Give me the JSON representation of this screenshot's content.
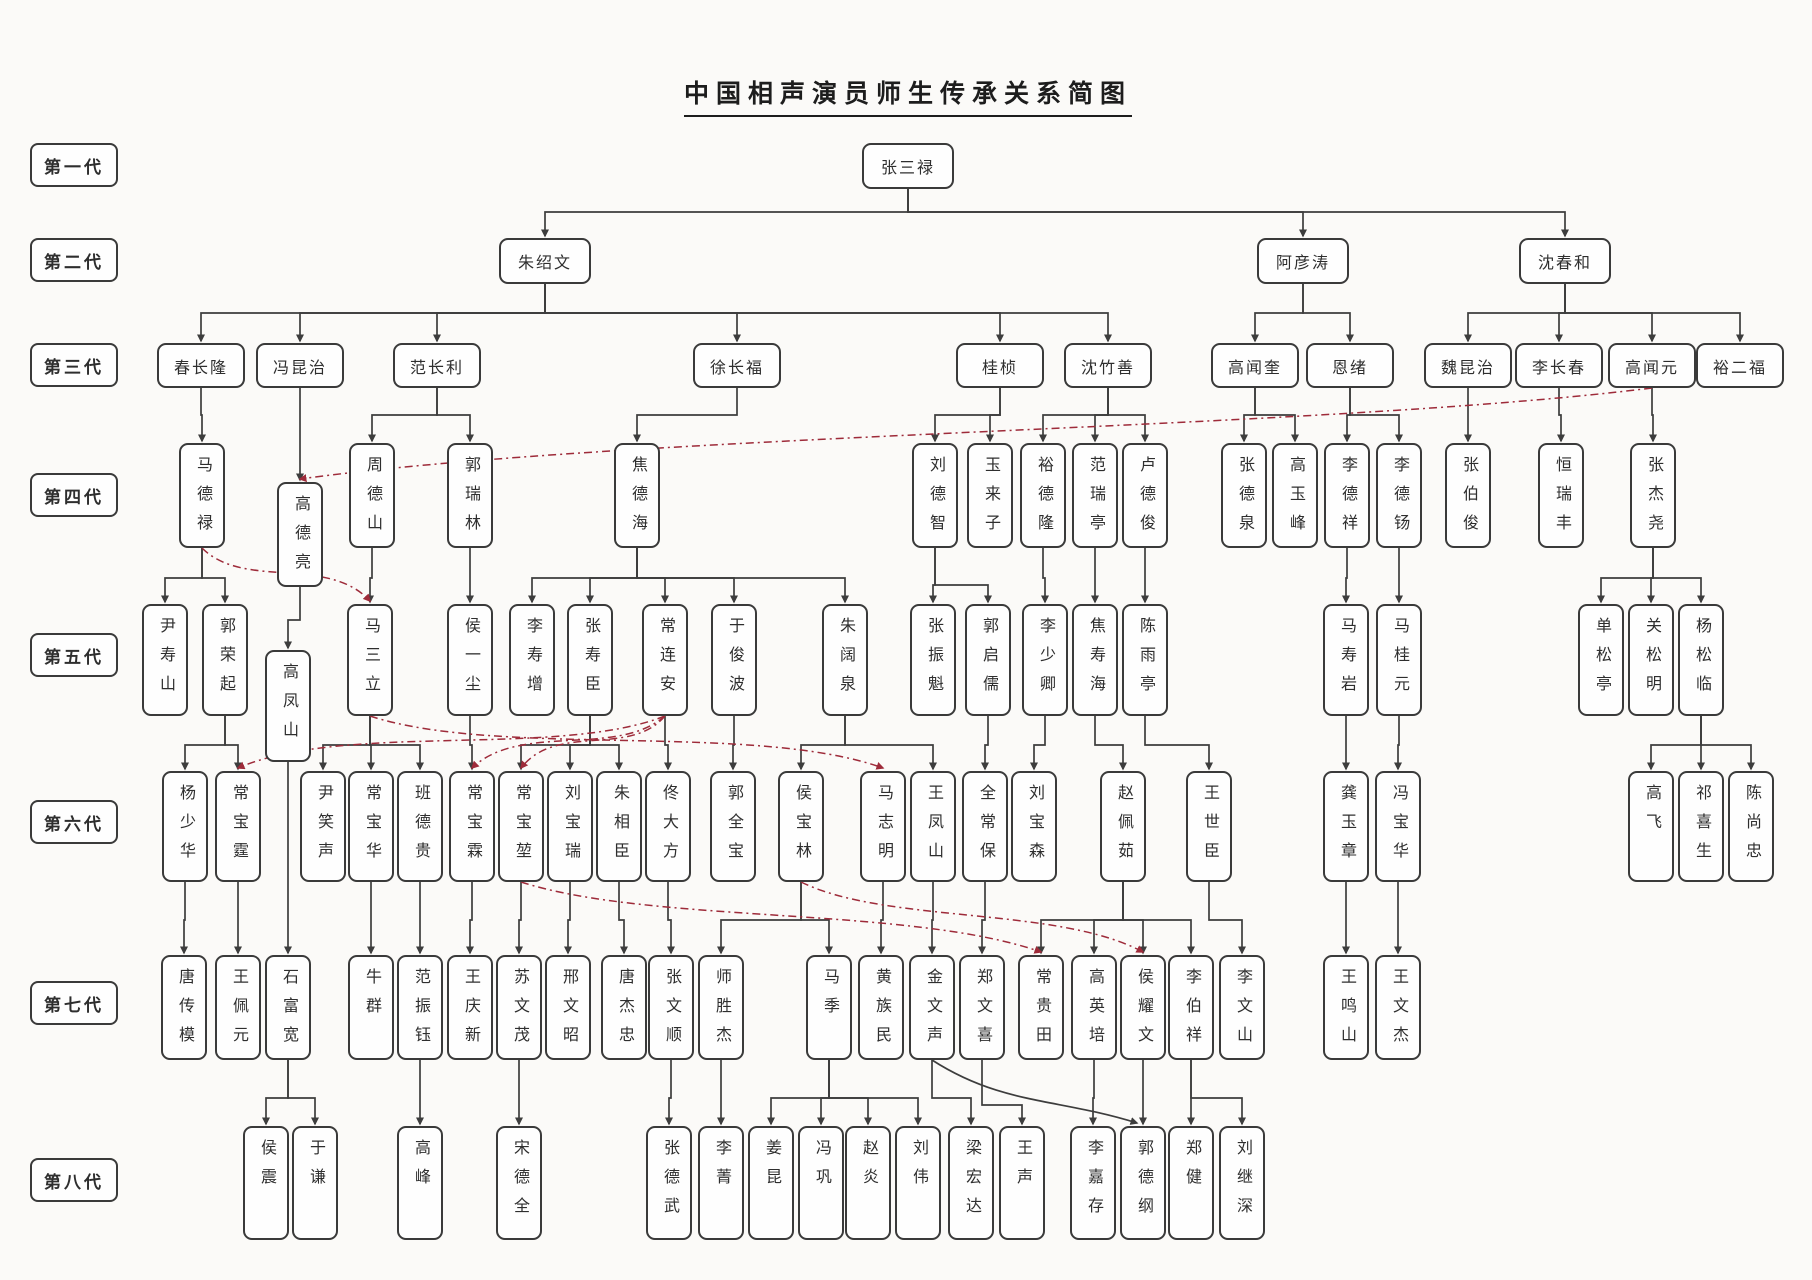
{
  "title": "中国相声演员师生传承关系简图",
  "colors": {
    "background": "#fbfaf8",
    "box_border": "#3a3a3a",
    "teacher_line": "#3d3d3d",
    "family_line": "#9e2b3a",
    "text": "#2e2e2e"
  },
  "generation_defaults": {
    "1": {
      "y": 143,
      "w": 92,
      "h": 46,
      "orient": "h"
    },
    "2": {
      "y": 238,
      "w": 92,
      "h": 46,
      "orient": "h"
    },
    "3": {
      "y": 343,
      "w": 88,
      "h": 45,
      "orient": "h"
    },
    "4": {
      "y": 443,
      "w": 46,
      "h": 105,
      "orient": "v"
    },
    "5": {
      "y": 604,
      "w": 46,
      "h": 112,
      "orient": "v"
    },
    "6": {
      "y": 771,
      "w": 46,
      "h": 111,
      "orient": "v"
    },
    "7": {
      "y": 955,
      "w": 46,
      "h": 105,
      "orient": "v"
    },
    "8": {
      "y": 1126,
      "w": 46,
      "h": 114,
      "orient": "v"
    }
  },
  "generations": [
    {
      "label": "第一代",
      "label_y": 143,
      "people": [
        {
          "name": "张三禄",
          "x": 908
        }
      ]
    },
    {
      "label": "第二代",
      "label_y": 238,
      "people": [
        {
          "name": "朱绍文",
          "x": 545
        },
        {
          "name": "阿彦涛",
          "x": 1303
        },
        {
          "name": "沈春和",
          "x": 1565
        }
      ]
    },
    {
      "label": "第三代",
      "label_y": 343,
      "people": [
        {
          "name": "春长隆",
          "x": 201
        },
        {
          "name": "冯昆治",
          "x": 300
        },
        {
          "name": "范长利",
          "x": 437
        },
        {
          "name": "徐长福",
          "x": 737
        },
        {
          "name": "桂桢",
          "x": 1000
        },
        {
          "name": "沈竹善",
          "x": 1108
        },
        {
          "name": "高闻奎",
          "x": 1255
        },
        {
          "name": "恩绪",
          "x": 1350
        },
        {
          "name": "魏昆治",
          "x": 1468
        },
        {
          "name": "李长春",
          "x": 1559
        },
        {
          "name": "高闻元",
          "x": 1652
        },
        {
          "name": "裕二福",
          "x": 1740
        }
      ]
    },
    {
      "label": "第四代",
      "label_y": 473,
      "people": [
        {
          "name": "马德禄",
          "x": 202
        },
        {
          "name": "高德亮",
          "x": 300,
          "y": 482
        },
        {
          "name": "周德山",
          "x": 372
        },
        {
          "name": "郭瑞林",
          "x": 470
        },
        {
          "name": "焦德海",
          "x": 637
        },
        {
          "name": "刘德智",
          "x": 935
        },
        {
          "name": "玉来子",
          "x": 990
        },
        {
          "name": "裕德隆",
          "x": 1043
        },
        {
          "name": "范瑞亭",
          "x": 1095
        },
        {
          "name": "卢德俊",
          "x": 1145
        },
        {
          "name": "张德泉",
          "x": 1244
        },
        {
          "name": "高玉峰",
          "x": 1295
        },
        {
          "name": "李德祥",
          "x": 1347
        },
        {
          "name": "李德钖",
          "x": 1399
        },
        {
          "name": "张伯俊",
          "x": 1468
        },
        {
          "name": "恒瑞丰",
          "x": 1561
        },
        {
          "name": "张杰尧",
          "x": 1653
        }
      ]
    },
    {
      "label": "第五代",
      "label_y": 633,
      "people": [
        {
          "name": "尹寿山",
          "x": 165
        },
        {
          "name": "郭荣起",
          "x": 225
        },
        {
          "name": "高凤山",
          "x": 288,
          "y": 650
        },
        {
          "name": "马三立",
          "x": 370
        },
        {
          "name": "侯一尘",
          "x": 470
        },
        {
          "name": "李寿增",
          "x": 532
        },
        {
          "name": "张寿臣",
          "x": 590
        },
        {
          "name": "常连安",
          "x": 665
        },
        {
          "name": "于俊波",
          "x": 734
        },
        {
          "name": "朱阔泉",
          "x": 845
        },
        {
          "name": "张振魁",
          "x": 933
        },
        {
          "name": "郭启儒",
          "x": 988
        },
        {
          "name": "李少卿",
          "x": 1045
        },
        {
          "name": "焦寿海",
          "x": 1095
        },
        {
          "name": "陈雨亭",
          "x": 1145
        },
        {
          "name": "马寿岩",
          "x": 1346
        },
        {
          "name": "马桂元",
          "x": 1399
        },
        {
          "name": "单松亭",
          "x": 1601
        },
        {
          "name": "关松明",
          "x": 1651
        },
        {
          "name": "杨松临",
          "x": 1701
        }
      ]
    },
    {
      "label": "第六代",
      "label_y": 800,
      "people": [
        {
          "name": "杨少华",
          "x": 185
        },
        {
          "name": "常宝霆",
          "x": 238
        },
        {
          "name": "尹笑声",
          "x": 323
        },
        {
          "name": "常宝华",
          "x": 371
        },
        {
          "name": "班德贵",
          "x": 420
        },
        {
          "name": "常宝霖",
          "x": 472
        },
        {
          "name": "常宝堃",
          "x": 521
        },
        {
          "name": "刘宝瑞",
          "x": 570
        },
        {
          "name": "朱相臣",
          "x": 619
        },
        {
          "name": "佟大方",
          "x": 668
        },
        {
          "name": "郭全宝",
          "x": 733
        },
        {
          "name": "侯宝林",
          "x": 801
        },
        {
          "name": "马志明",
          "x": 883
        },
        {
          "name": "王凤山",
          "x": 933
        },
        {
          "name": "全常保",
          "x": 985
        },
        {
          "name": "刘宝森",
          "x": 1034
        },
        {
          "name": "赵佩茹",
          "x": 1123
        },
        {
          "name": "王世臣",
          "x": 1209
        },
        {
          "name": "龚玉章",
          "x": 1346
        },
        {
          "name": "冯宝华",
          "x": 1398
        },
        {
          "name": "高飞",
          "x": 1651
        },
        {
          "name": "祁喜生",
          "x": 1701
        },
        {
          "name": "陈尚忠",
          "x": 1751
        }
      ]
    },
    {
      "label": "第七代",
      "label_y": 981,
      "people": [
        {
          "name": "唐传模",
          "x": 184
        },
        {
          "name": "王佩元",
          "x": 238
        },
        {
          "name": "石富宽",
          "x": 288
        },
        {
          "name": "牛群",
          "x": 371
        },
        {
          "name": "范振钰",
          "x": 420
        },
        {
          "name": "王庆新",
          "x": 470
        },
        {
          "name": "苏文茂",
          "x": 519
        },
        {
          "name": "邢文昭",
          "x": 568
        },
        {
          "name": "唐杰忠",
          "x": 624
        },
        {
          "name": "张文顺",
          "x": 671
        },
        {
          "name": "师胜杰",
          "x": 721
        },
        {
          "name": "马季",
          "x": 829
        },
        {
          "name": "黄族民",
          "x": 881
        },
        {
          "name": "金文声",
          "x": 932
        },
        {
          "name": "郑文喜",
          "x": 982
        },
        {
          "name": "常贵田",
          "x": 1041
        },
        {
          "name": "高英培",
          "x": 1094
        },
        {
          "name": "侯耀文",
          "x": 1143
        },
        {
          "name": "李伯祥",
          "x": 1191
        },
        {
          "name": "李文山",
          "x": 1242
        },
        {
          "name": "王鸣山",
          "x": 1346
        },
        {
          "name": "王文杰",
          "x": 1398
        }
      ]
    },
    {
      "label": "第八代",
      "label_y": 1158,
      "people": [
        {
          "name": "侯震",
          "x": 266
        },
        {
          "name": "于谦",
          "x": 315
        },
        {
          "name": "高峰",
          "x": 420
        },
        {
          "name": "宋德全",
          "x": 519
        },
        {
          "name": "张德武",
          "x": 669
        },
        {
          "name": "李菁",
          "x": 721
        },
        {
          "name": "姜昆",
          "x": 771
        },
        {
          "name": "冯巩",
          "x": 821
        },
        {
          "name": "赵炎",
          "x": 868
        },
        {
          "name": "刘伟",
          "x": 918
        },
        {
          "name": "梁宏达",
          "x": 971
        },
        {
          "name": "王声",
          "x": 1022
        },
        {
          "name": "李嘉存",
          "x": 1093
        },
        {
          "name": "郭德纲",
          "x": 1143
        },
        {
          "name": "郑健",
          "x": 1191
        },
        {
          "name": "刘继深",
          "x": 1242
        }
      ]
    }
  ],
  "teacher_edges": [
    {
      "from": "张三禄",
      "to": [
        "朱绍文",
        "阿彦涛",
        "沈春和"
      ],
      "bus": 212
    },
    {
      "from": "朱绍文",
      "to": [
        "春长隆",
        "冯昆治",
        "范长利",
        "徐长福",
        "桂桢",
        "沈竹善"
      ],
      "bus": 313
    },
    {
      "from": "阿彦涛",
      "to": [
        "高闻奎",
        "恩绪"
      ],
      "bus": 313
    },
    {
      "from": "沈春和",
      "to": [
        "魏昆治",
        "李长春",
        "高闻元",
        "裕二福"
      ],
      "bus": 313
    },
    {
      "from": "春长隆",
      "to": [
        "马德禄"
      ],
      "bus": 415
    },
    {
      "from": "冯昆治",
      "to": [
        "高德亮"
      ],
      "bus": 415
    },
    {
      "from": "范长利",
      "to": [
        "周德山",
        "郭瑞林"
      ],
      "bus": 415
    },
    {
      "from": "徐长福",
      "to": [
        "焦德海"
      ],
      "bus": 415
    },
    {
      "from": "桂桢",
      "to": [
        "刘德智",
        "玉来子"
      ],
      "bus": 415
    },
    {
      "from": "沈竹善",
      "to": [
        "裕德隆",
        "范瑞亭",
        "卢德俊"
      ],
      "bus": 415
    },
    {
      "from": "高闻奎",
      "to": [
        "张德泉",
        "高玉峰"
      ],
      "bus": 415
    },
    {
      "from": "恩绪",
      "to": [
        "李德祥",
        "李德钖"
      ],
      "bus": 415
    },
    {
      "from": "魏昆治",
      "to": [
        "张伯俊"
      ],
      "bus": 415
    },
    {
      "from": "李长春",
      "to": [
        "恒瑞丰"
      ],
      "bus": 415
    },
    {
      "from": "高闻元",
      "to": [
        "张杰尧"
      ],
      "bus": 415
    },
    {
      "from": "马德禄",
      "to": [
        "尹寿山",
        "郭荣起"
      ],
      "bus": 578
    },
    {
      "from": "高德亮",
      "to": [
        "高凤山"
      ],
      "bus": 620
    },
    {
      "from": "周德山",
      "to": [
        "马三立"
      ],
      "bus": 578
    },
    {
      "from": "郭瑞林",
      "to": [
        "侯一尘"
      ],
      "bus": 578
    },
    {
      "from": "焦德海",
      "to": [
        "李寿增",
        "张寿臣",
        "常连安",
        "于俊波",
        "朱阔泉"
      ],
      "bus": 578
    },
    {
      "from": "刘德智",
      "to": [
        "张振魁",
        "郭启儒"
      ],
      "bus": 585
    },
    {
      "from": "裕德隆",
      "to": [
        "李少卿"
      ],
      "bus": 578
    },
    {
      "from": "范瑞亭",
      "to": [
        "焦寿海"
      ],
      "bus": 578
    },
    {
      "from": "卢德俊",
      "to": [
        "陈雨亭"
      ],
      "bus": 578
    },
    {
      "from": "李德祥",
      "to": [
        "马寿岩"
      ],
      "bus": 578
    },
    {
      "from": "李德钖",
      "to": [
        "马桂元"
      ],
      "bus": 578
    },
    {
      "from": "张杰尧",
      "to": [
        "单松亭",
        "关松明",
        "杨松临"
      ],
      "bus": 578
    },
    {
      "from": "郭荣起",
      "to": [
        "杨少华",
        "常宝霆"
      ],
      "bus": 745
    },
    {
      "from": "高凤山",
      "to": [
        "石富宽"
      ],
      "direct": true
    },
    {
      "from": "马三立",
      "to": [
        "尹笑声",
        "常宝华",
        "班德贵"
      ],
      "bus": 745
    },
    {
      "from": "侯一尘",
      "to": [
        "常宝霖"
      ],
      "bus": 745
    },
    {
      "from": "张寿臣",
      "to": [
        "常宝堃",
        "刘宝瑞",
        "朱相臣"
      ],
      "bus": 745
    },
    {
      "from": "常连安",
      "to": [
        "佟大方"
      ],
      "bus": 745
    },
    {
      "from": "于俊波",
      "to": [
        "郭全宝"
      ],
      "bus": 745
    },
    {
      "from": "朱阔泉",
      "to": [
        "侯宝林",
        "王凤山"
      ],
      "bus": 745
    },
    {
      "from": "郭启儒",
      "to": [
        "全常保"
      ],
      "bus": 745
    },
    {
      "from": "李少卿",
      "to": [
        "刘宝森"
      ],
      "bus": 745
    },
    {
      "from": "焦寿海",
      "to": [
        "赵佩茹"
      ],
      "bus": 745
    },
    {
      "from": "陈雨亭",
      "to": [
        "王世臣"
      ],
      "bus": 745
    },
    {
      "from": "马寿岩",
      "to": [
        "龚玉章"
      ],
      "bus": 745
    },
    {
      "from": "马桂元",
      "to": [
        "冯宝华"
      ],
      "bus": 745
    },
    {
      "from": "杨松临",
      "to": [
        "高飞",
        "祁喜生",
        "陈尚忠"
      ],
      "bus": 745
    },
    {
      "from": "杨少华",
      "to": [
        "唐传模"
      ],
      "bus": 920
    },
    {
      "from": "常宝霆",
      "to": [
        "王佩元"
      ],
      "bus": 920
    },
    {
      "from": "常宝华",
      "to": [
        "牛群"
      ],
      "bus": 920
    },
    {
      "from": "班德贵",
      "to": [
        "范振钰"
      ],
      "bus": 920
    },
    {
      "from": "常宝霖",
      "to": [
        "王庆新"
      ],
      "bus": 920
    },
    {
      "from": "常宝堃",
      "to": [
        "苏文茂"
      ],
      "bus": 920
    },
    {
      "from": "刘宝瑞",
      "to": [
        "邢文昭"
      ],
      "bus": 920
    },
    {
      "from": "朱相臣",
      "to": [
        "唐杰忠"
      ],
      "bus": 920
    },
    {
      "from": "佟大方",
      "to": [
        "张文顺"
      ],
      "bus": 920
    },
    {
      "from": "侯宝林",
      "to": [
        "师胜杰",
        "马季"
      ],
      "bus": 920
    },
    {
      "from": "马志明",
      "to": [
        "黄族民"
      ],
      "bus": 920
    },
    {
      "from": "王凤山",
      "to": [
        "金文声"
      ],
      "bus": 920
    },
    {
      "from": "全常保",
      "to": [
        "郑文喜"
      ],
      "bus": 920
    },
    {
      "from": "赵佩茹",
      "to": [
        "常贵田",
        "高英培",
        "侯耀文",
        "李伯祥"
      ],
      "bus": 920
    },
    {
      "from": "王世臣",
      "to": [
        "李文山"
      ],
      "bus": 920
    },
    {
      "from": "龚玉章",
      "to": [
        "王鸣山"
      ],
      "bus": 920
    },
    {
      "from": "冯宝华",
      "to": [
        "王文杰"
      ],
      "bus": 920
    },
    {
      "from": "石富宽",
      "to": [
        "侯震",
        "于谦"
      ],
      "bus": 1098
    },
    {
      "from": "范振钰",
      "to": [
        "高峰"
      ],
      "bus": 1098
    },
    {
      "from": "苏文茂",
      "to": [
        "宋德全"
      ],
      "bus": 1098
    },
    {
      "from": "张文顺",
      "to": [
        "张德武"
      ],
      "bus": 1098
    },
    {
      "from": "师胜杰",
      "to": [
        "李菁"
      ],
      "bus": 1098
    },
    {
      "from": "马季",
      "to": [
        "姜昆",
        "冯巩",
        "赵炎",
        "刘伟"
      ],
      "bus": 1098
    },
    {
      "from": "金文声",
      "to": [
        "梁宏达"
      ],
      "bus": 1098
    },
    {
      "from": "郑文喜",
      "to": [
        "王声"
      ],
      "bus": 1105
    },
    {
      "from": "高英培",
      "to": [
        "李嘉存"
      ],
      "bus": 1098
    },
    {
      "from": "侯耀文",
      "to": [
        "郭德纲"
      ],
      "bus": 1098
    },
    {
      "from": "李伯祥",
      "to": [
        "郑健",
        "刘继深"
      ],
      "bus": 1098
    }
  ],
  "family_edges": [
    {
      "from": "高闻元",
      "to": "高德亮"
    },
    {
      "from": "马德禄",
      "to": "马三立"
    },
    {
      "from": "常连安",
      "to": "常宝霆"
    },
    {
      "from": "常连安",
      "to": "常宝霖"
    },
    {
      "from": "常连安",
      "to": "常宝堃"
    },
    {
      "from": "马三立",
      "to": "马志明"
    },
    {
      "from": "常宝堃",
      "to": "常贵田"
    },
    {
      "from": "侯宝林",
      "to": "侯耀文"
    }
  ],
  "mentor_curve_edges": [
    {
      "from": "金文声",
      "to": "郭德纲"
    }
  ]
}
